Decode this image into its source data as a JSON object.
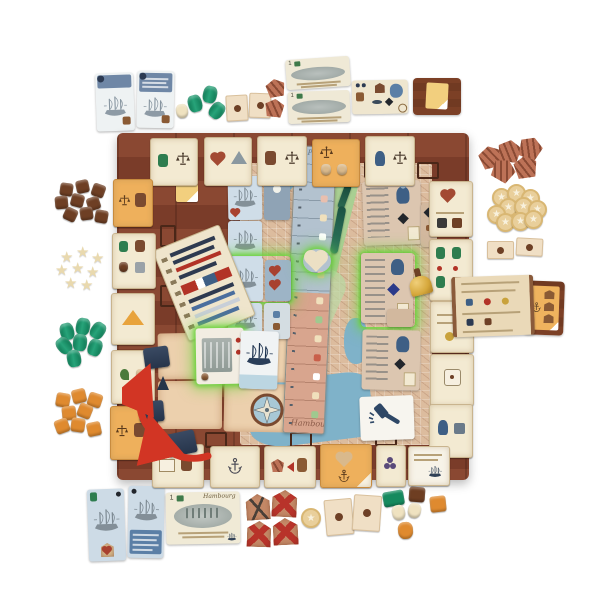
{
  "labels": {
    "track_top_script": "Plan",
    "track_bottom_script": "Hambourg",
    "money_card_script": "Hambourg",
    "money_value": "1"
  },
  "icons": {
    "star": "★"
  },
  "colors": {
    "board_frame": "#7d3f2b",
    "map_land": "#dcbc9e",
    "water_blue": "#7fb2c9",
    "park_green": "#a9cf92",
    "parchment_tile": "#f3ead2",
    "orange_tile": "#eeb05c",
    "highlight_green": "#6ed33f",
    "arrow_red": "#d23524",
    "player_navy": "#2c3a52",
    "goods_teal": "#178a62",
    "goods_brown": "#6e3f24",
    "goods_orange": "#df8a2f",
    "goods_cream": "#efe2c0",
    "coin_gold": "#e9cf9b",
    "ship_card_blue": "#cfdde8",
    "building_card_tan": "#dcc6b0"
  },
  "inventory": {
    "left_token_clusters": [
      {
        "name": "brown sack tokens",
        "count": 9
      },
      {
        "name": "cream star tokens",
        "count": 8
      },
      {
        "name": "teal barrel tokens",
        "count": 7
      },
      {
        "name": "orange sack tokens",
        "count": 8
      }
    ],
    "right_token_clusters": [
      {
        "name": "timber bundle tiles",
        "count": 5
      },
      {
        "name": "star coins",
        "count": 10
      },
      {
        "name": "seal domino tiles",
        "count": 2
      }
    ],
    "top_components": [
      "2 blue ship cards",
      "3 green barrels",
      "1 cream sack",
      "2 seal tiles",
      "2 engraved note cards",
      "1 reference card",
      "1 brown card back"
    ],
    "bottom_components": [
      "2 blue ship cards",
      "1 Hambourg note card",
      "4 crest tokens (3 with red X)",
      "1 star coin",
      "2 seal tiles",
      "6 wooden goods pieces"
    ],
    "board_features": [
      "wooden frame with scroll border tiles",
      "Hamburg city map",
      "central river track with heart token",
      "ship card column (green highlighted)",
      "building cards (green highlighted)",
      "price list tile",
      "reference scroll",
      "auction gavel card",
      "compass rose",
      "brass bell",
      "red movement arrows with navy markers"
    ]
  }
}
